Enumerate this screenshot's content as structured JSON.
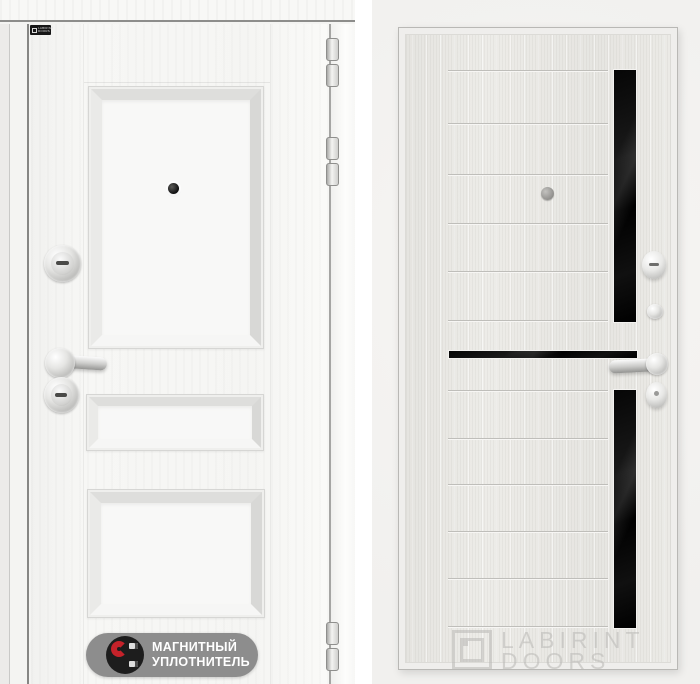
{
  "left_panel": {
    "brand_plate": {
      "text": "LABIRINT DOORS"
    },
    "seal_badge": {
      "line1": "МАГНИТНЫЙ",
      "line2": "УПЛОТНИТЕЛЬ"
    }
  },
  "right_panel": {
    "watermark": {
      "line1": "LABIRINT",
      "line2": "DOORS"
    }
  },
  "colors": {
    "photo_background": "#f4f3f1",
    "door_exterior_white": "#f6f6f4",
    "door_interior_sandal": "#e9e8e4",
    "glass_black": "#0a0a0a",
    "badge_pill_gray": "#8d8d8d",
    "magnet_red": "#c5222a",
    "watermark_gray": "#b9b8b5",
    "chrome": "#c9c9c7"
  }
}
